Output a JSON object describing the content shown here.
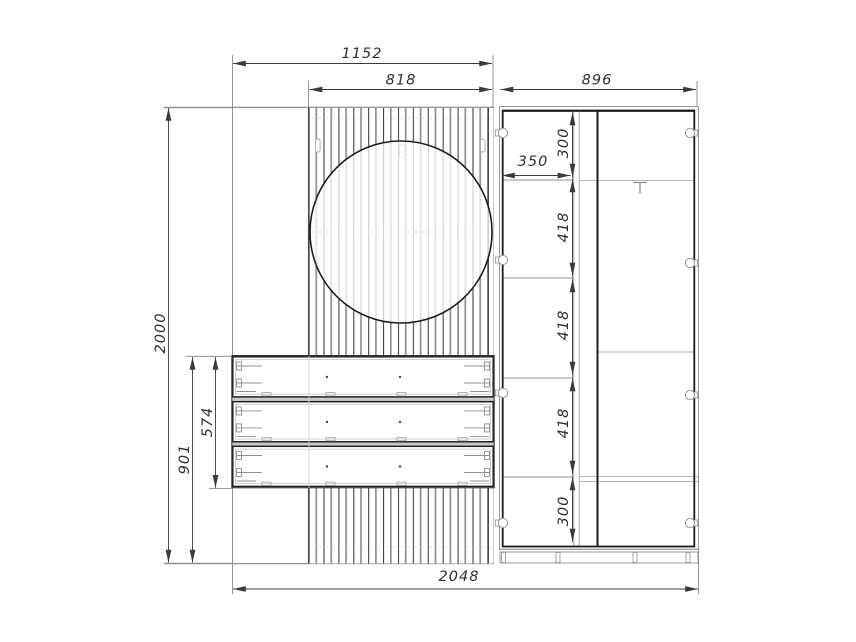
{
  "drawing": {
    "labels": {
      "panel_width": "1152",
      "slat_panel_width": "818",
      "wardrobe_width": "896",
      "total_height": "2000",
      "drawer_section_height": "901",
      "drawer_block_height": "574",
      "shelf_width": "350",
      "compartment_top": "300",
      "compartment_mid_a": "418",
      "compartment_mid_b": "418",
      "compartment_mid_c": "418",
      "compartment_bottom": "300",
      "total_width": "2048"
    },
    "colors": {
      "background": "#ffffff",
      "outline_dark": "#1f1f1f",
      "carcass_gray": "#8f8f8f",
      "dimension": "#3a3a3a"
    }
  }
}
